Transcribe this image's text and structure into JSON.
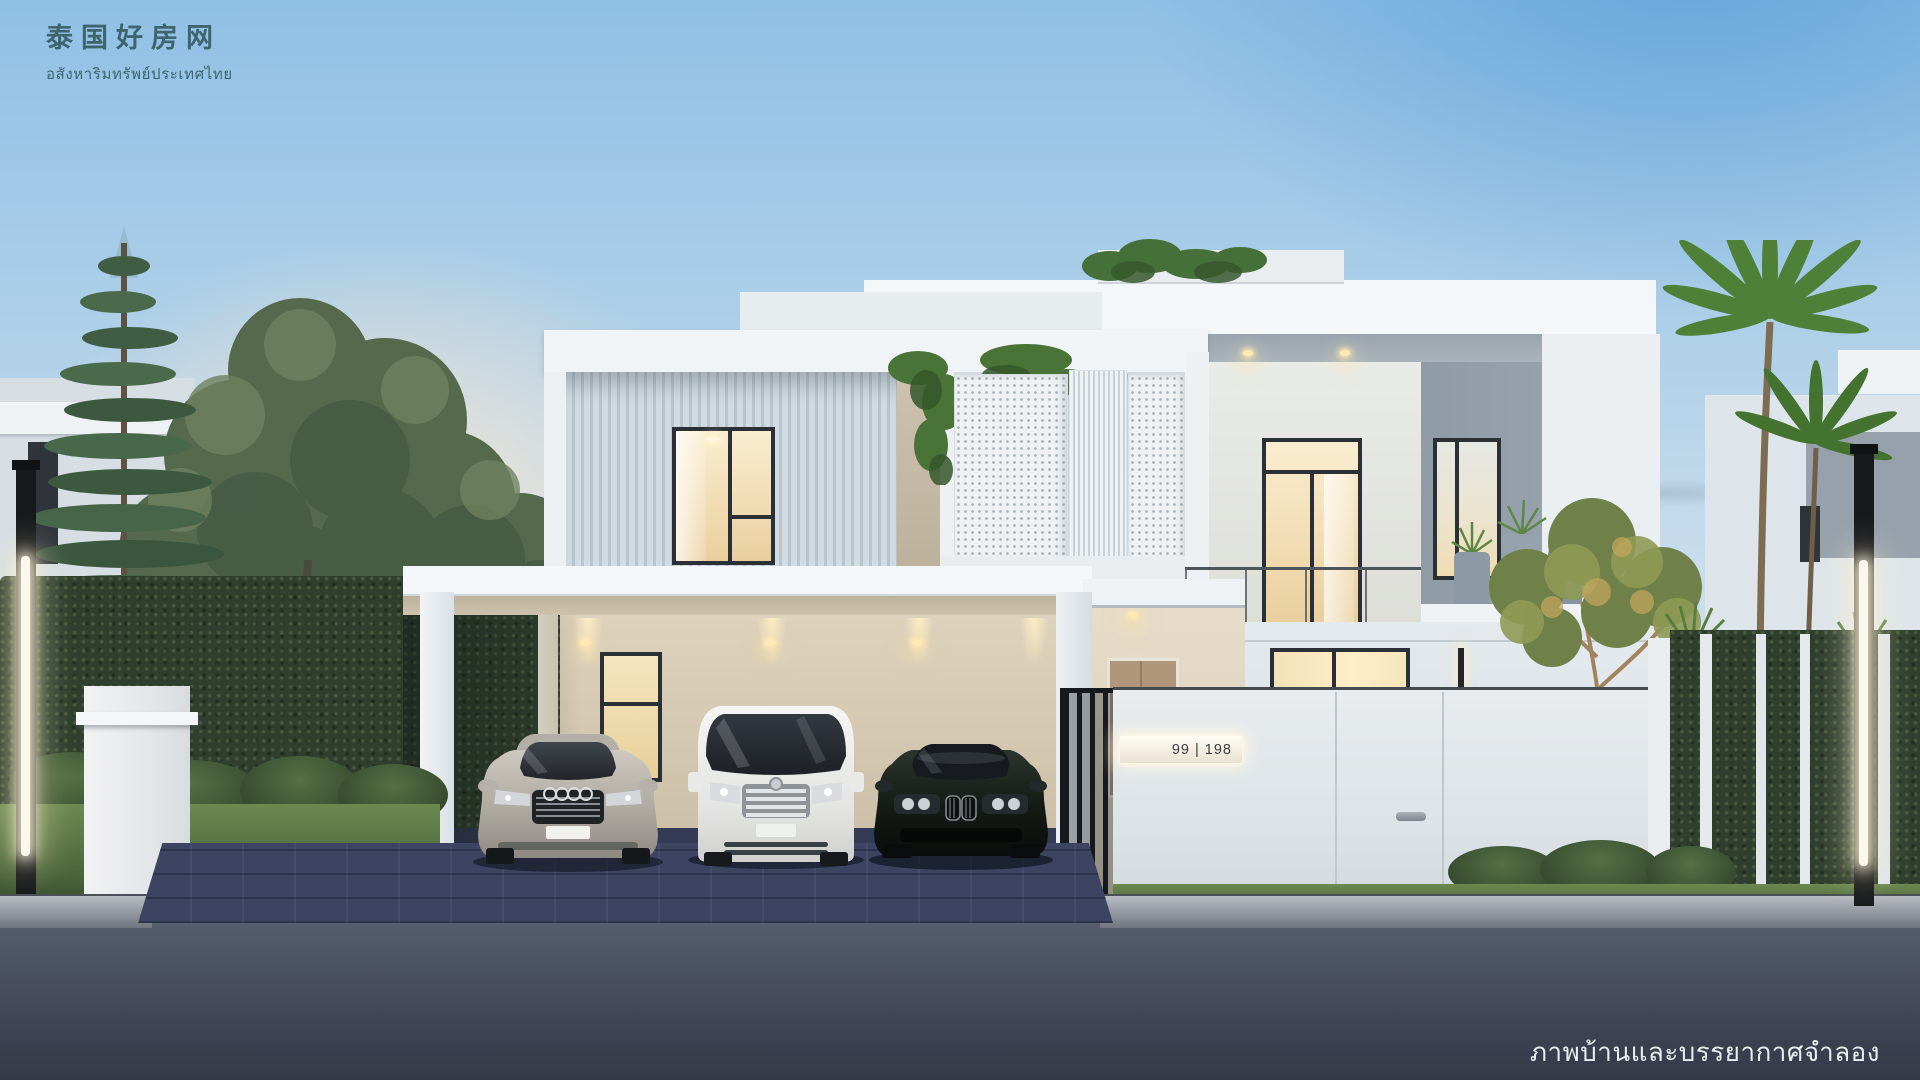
{
  "watermark": {
    "logo_cn": "泰国好房网",
    "logo_sub": "อสังหาริมทรัพย์ประเทศไทย",
    "disclaimer": "ภาพบ้านและบรรยากาศจำลอง"
  },
  "house": {
    "address_plate": "99 | 198"
  },
  "colors": {
    "sky_top": "#8fc0e6",
    "sky_mid": "#c7dcec",
    "sun_glow": "#ffe9cf",
    "white": "#eef2f5",
    "white_hi": "#f4f7f9",
    "slat": "#c8d3da",
    "panel_gray": "#96a1ab",
    "soffit": "#9aa4ad",
    "frame": "#2b3036",
    "glass_warm_hi": "#f9edd0",
    "glass_warm": "#e9cf9e",
    "carport_wall": "#d9cdb6",
    "wood_door": "#b0977b",
    "hedge": "#2f3e2d",
    "leaf": "#5a7c44",
    "palm": "#4f8038",
    "grass": "#4c663c",
    "pot": "#8e9bа7",
    "paver": "#3c4462",
    "road_top": "#575f70",
    "road_bottom": "#343a48",
    "curb": "#9ba0a8",
    "gate_dark": "#16191d",
    "logo_color": "#3e646e",
    "plate_text": "#393e43"
  }
}
